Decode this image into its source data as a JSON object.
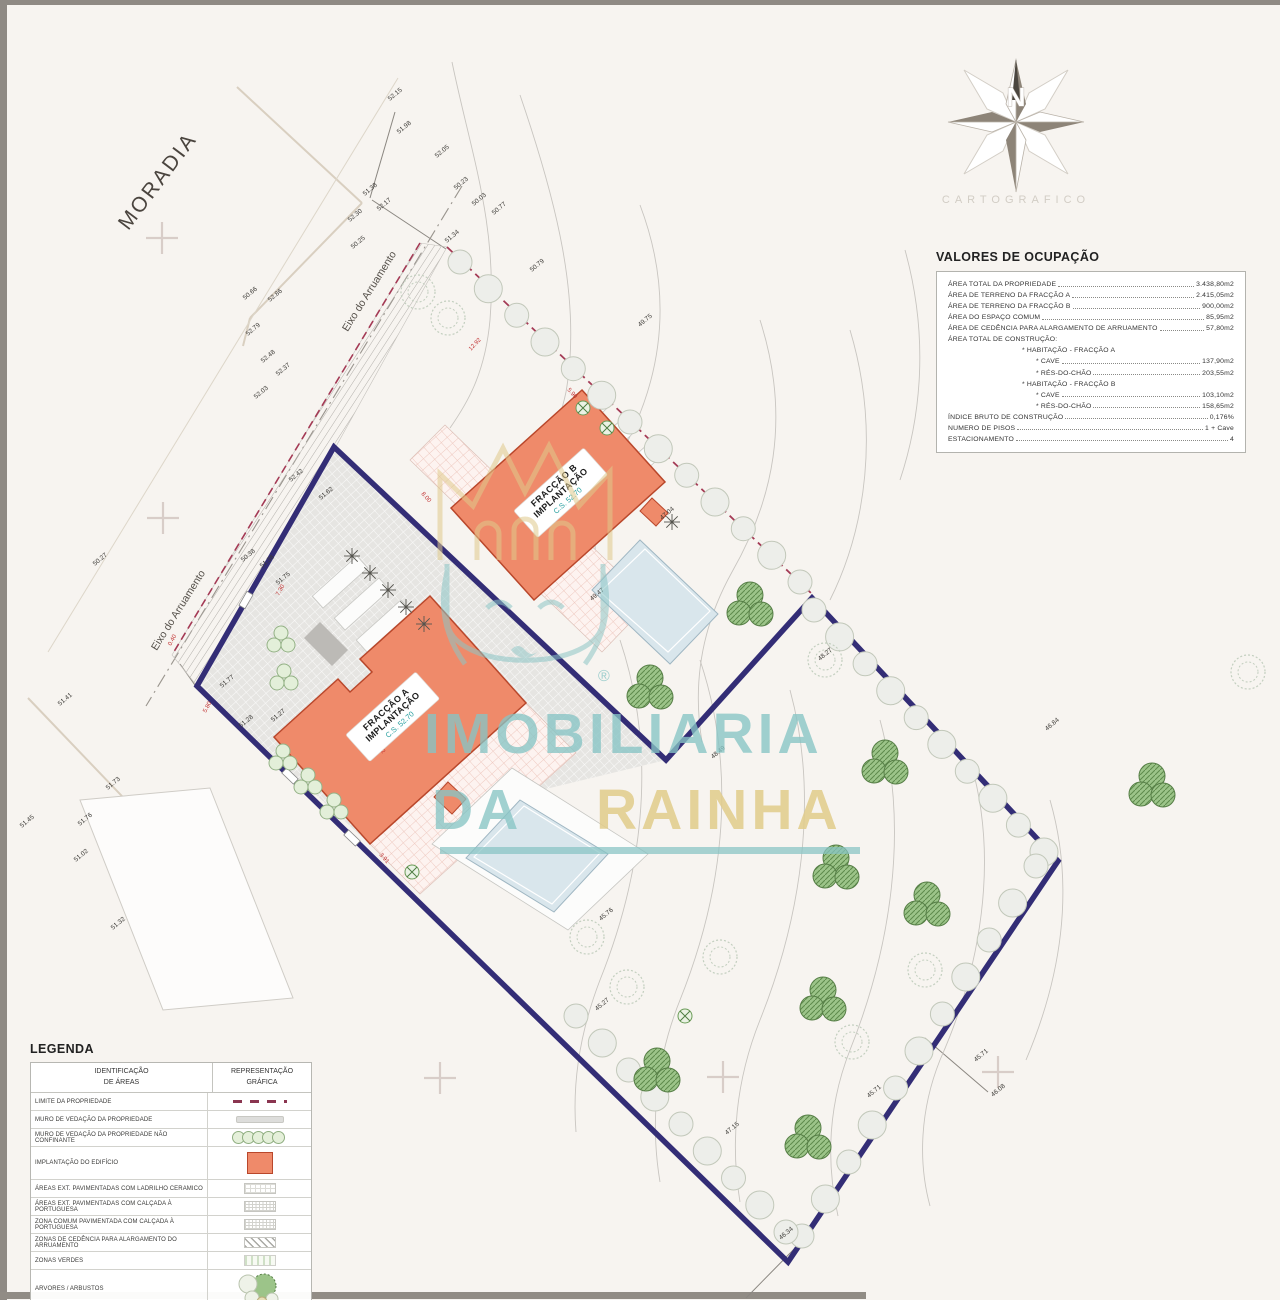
{
  "colors": {
    "salmon": "#ef8a6a",
    "salmon_border": "#b9472b",
    "navy": "#332d76",
    "limit_red": "#a43a55",
    "teal": "#86c4c4",
    "gold": "#e0cb8c",
    "pool": "#d9e6ec",
    "paving": "#e6e5e2"
  },
  "compass": {
    "north": "N",
    "caption": "CARTOGRAFICO"
  },
  "watermark": {
    "word1": "IMOBILIARIA",
    "word2": "DA",
    "word3": "RAINHA",
    "reg": "®"
  },
  "plan": {
    "moradia": "MORADIA",
    "eixo_label": "Eixo do Arruamento",
    "building_a": {
      "name": "FRACÇÃO A",
      "sub": "IMPLANTAÇÃO",
      "cs": "C.S. 52.70"
    },
    "building_b": {
      "name": "FRACÇÃO B",
      "sub": "IMPLANTAÇÃO",
      "cs": "C.S. 52.70"
    },
    "elevations": [
      {
        "v": "52.15",
        "x": 390,
        "y": 101
      },
      {
        "v": "51.98",
        "x": 399,
        "y": 134
      },
      {
        "v": "52.05",
        "x": 437,
        "y": 158
      },
      {
        "v": "51.38",
        "x": 365,
        "y": 196
      },
      {
        "v": "52.30",
        "x": 350,
        "y": 222
      },
      {
        "v": "52.17",
        "x": 379,
        "y": 211
      },
      {
        "v": "50.25",
        "x": 353,
        "y": 249
      },
      {
        "v": "50.66",
        "x": 245,
        "y": 300
      },
      {
        "v": "52.86",
        "x": 270,
        "y": 302
      },
      {
        "v": "52.79",
        "x": 248,
        "y": 336
      },
      {
        "v": "52.48",
        "x": 263,
        "y": 363
      },
      {
        "v": "52.37",
        "x": 278,
        "y": 376
      },
      {
        "v": "52.03",
        "x": 256,
        "y": 399
      },
      {
        "v": "50.23",
        "x": 456,
        "y": 190
      },
      {
        "v": "50.03",
        "x": 474,
        "y": 206
      },
      {
        "v": "50.77",
        "x": 494,
        "y": 215
      },
      {
        "v": "51.34",
        "x": 447,
        "y": 243
      },
      {
        "v": "50.79",
        "x": 532,
        "y": 272
      },
      {
        "v": "49.75",
        "x": 640,
        "y": 327
      },
      {
        "v": "52.42",
        "x": 291,
        "y": 482
      },
      {
        "v": "51.62",
        "x": 321,
        "y": 500
      },
      {
        "v": "50.38",
        "x": 243,
        "y": 562
      },
      {
        "v": "51.36",
        "x": 262,
        "y": 568
      },
      {
        "v": "51.75",
        "x": 278,
        "y": 585
      },
      {
        "v": "50.27",
        "x": 95,
        "y": 566
      },
      {
        "v": "51.41",
        "x": 60,
        "y": 706
      },
      {
        "v": "51.77",
        "x": 222,
        "y": 688
      },
      {
        "v": "51.28",
        "x": 241,
        "y": 728
      },
      {
        "v": "51.27",
        "x": 273,
        "y": 722
      },
      {
        "v": "51.73",
        "x": 108,
        "y": 790
      },
      {
        "v": "51.76",
        "x": 80,
        "y": 826
      },
      {
        "v": "51.45",
        "x": 22,
        "y": 828
      },
      {
        "v": "51.02",
        "x": 76,
        "y": 862
      },
      {
        "v": "51.32",
        "x": 113,
        "y": 930
      },
      {
        "v": "49.47",
        "x": 592,
        "y": 601
      },
      {
        "v": "47.04",
        "x": 662,
        "y": 520
      },
      {
        "v": "48.27",
        "x": 820,
        "y": 661
      },
      {
        "v": "46.84",
        "x": 1047,
        "y": 731
      },
      {
        "v": "48.49",
        "x": 713,
        "y": 759
      },
      {
        "v": "45.76",
        "x": 601,
        "y": 921
      },
      {
        "v": "45.27",
        "x": 597,
        "y": 1011
      },
      {
        "v": "47.15",
        "x": 727,
        "y": 1135
      },
      {
        "v": "45.71",
        "x": 976,
        "y": 1062
      },
      {
        "v": "46.08",
        "x": 993,
        "y": 1097
      },
      {
        "v": "45.71",
        "x": 869,
        "y": 1098
      },
      {
        "v": "46.34",
        "x": 781,
        "y": 1240
      }
    ],
    "dimensions": [
      {
        "v": "12.92",
        "x": 471,
        "y": 351,
        "r": -47
      },
      {
        "v": "5.90",
        "x": 567,
        "y": 390,
        "r": 48
      },
      {
        "v": "8.00",
        "x": 421,
        "y": 494,
        "r": 48
      },
      {
        "v": "7.30",
        "x": 279,
        "y": 596,
        "r": -62
      },
      {
        "v": "3.92",
        "x": 375,
        "y": 745,
        "r": 48
      },
      {
        "v": "3.91",
        "x": 379,
        "y": 855,
        "r": 48
      },
      {
        "v": "0.40",
        "x": 171,
        "y": 646,
        "r": -62
      },
      {
        "v": "5.80",
        "x": 206,
        "y": 713,
        "r": -62
      }
    ],
    "crosses": [
      [
        162,
        238
      ],
      [
        163,
        518
      ],
      [
        440,
        1078
      ],
      [
        723,
        1077
      ],
      [
        998,
        1072
      ]
    ],
    "shrub_rows": [
      {
        "from": [
          460,
          262
        ],
        "to": [
          800,
          582
        ],
        "n": 13
      },
      {
        "from": [
          814,
          610
        ],
        "to": [
          1044,
          852
        ],
        "n": 10
      },
      {
        "from": [
          1036,
          866
        ],
        "to": [
          802,
          1236
        ],
        "n": 11
      },
      {
        "from": [
          576,
          1016
        ],
        "to": [
          786,
          1232
        ],
        "n": 9
      }
    ],
    "tree_clusters": [
      [
        750,
        607
      ],
      [
        650,
        690
      ],
      [
        885,
        765
      ],
      [
        1152,
        788
      ],
      [
        836,
        870
      ],
      [
        927,
        907
      ],
      [
        823,
        1002
      ],
      [
        657,
        1073
      ],
      [
        808,
        1140
      ]
    ],
    "outline_trees": [
      [
        587,
        937
      ],
      [
        627,
        987
      ],
      [
        720,
        957
      ],
      [
        852,
        1042
      ],
      [
        925,
        970
      ],
      [
        825,
        660
      ],
      [
        418,
        292
      ],
      [
        448,
        318
      ],
      [
        1248,
        672
      ]
    ],
    "x_trees": [
      [
        583,
        408
      ],
      [
        607,
        428
      ],
      [
        412,
        872
      ],
      [
        685,
        1016
      ]
    ],
    "spiky_trees": [
      [
        352,
        556
      ],
      [
        370,
        573
      ],
      [
        388,
        590
      ],
      [
        406,
        607
      ],
      [
        424,
        624
      ],
      [
        672,
        522
      ]
    ],
    "green_dots": [
      [
        281,
        640
      ],
      [
        284,
        678
      ],
      [
        283,
        758
      ],
      [
        308,
        782
      ],
      [
        334,
        807
      ]
    ]
  },
  "valores": {
    "title": "VALORES DE OCUPAÇÃO",
    "rows": [
      {
        "label": "ÁREA TOTAL DA PROPRIEDADE",
        "value": "3.438,80m2",
        "indent": 0
      },
      {
        "label": "ÁREA DE TERRENO DA FRACÇÃO A",
        "value": "2.415,05m2",
        "indent": 0
      },
      {
        "label": "ÁREA DE TERRENO DA FRACÇÃO B",
        "value": "900,00m2",
        "indent": 0
      },
      {
        "label": "ÁREA DO ESPAÇO COMUM",
        "value": "85,95m2",
        "indent": 0
      },
      {
        "label": "ÁREA DE CEDÊNCIA PARA ALARGAMENTO DE ARRUAMENTO",
        "value": "57,80m2",
        "indent": 0
      },
      {
        "label": "ÁREA TOTAL DE CONSTRUÇÃO:",
        "value": "",
        "indent": 0
      },
      {
        "label": "* HABITAÇÃO - FRACÇÃO A",
        "value": "",
        "indent": 1
      },
      {
        "label": "* CAVE",
        "value": "137,90m2",
        "indent": 2
      },
      {
        "label": "* RÉS-DO-CHÃO",
        "value": "203,55m2",
        "indent": 2
      },
      {
        "label": "* HABITAÇÃO - FRACÇÃO B",
        "value": "",
        "indent": 1
      },
      {
        "label": "* CAVE",
        "value": "103,10m2",
        "indent": 2
      },
      {
        "label": "* RÉS-DO-CHÃO",
        "value": "158,65m2",
        "indent": 2
      },
      {
        "label": "ÍNDICE BRUTO DE CONSTRUÇÃO",
        "value": "0,176%",
        "indent": 0
      },
      {
        "label": "NUMERO DE PISOS",
        "value": "1 + Cave",
        "indent": 0
      },
      {
        "label": "ESTACIONAMENTO",
        "value": "4",
        "indent": 0
      }
    ]
  },
  "legend": {
    "title": "LEGENDA",
    "header": {
      "c1a": "IDENTIFICAÇÃO",
      "c1b": "DE ÁREAS",
      "c2a": "REPRESENTAÇÃO",
      "c2b": "GRÁFICA"
    },
    "rows": [
      {
        "label": "LIMITE DA PROPRIEDADE",
        "symbol": "limit"
      },
      {
        "label": "MURO DE VEDAÇÃO DA PROPRIEDADE",
        "symbol": "wall"
      },
      {
        "label": "MURO DE VEDAÇÃO DA PROPRIEDADE NÃO CONFINANTE",
        "symbol": "hedge"
      },
      {
        "label": "IMPLANTAÇÃO DO EDIFÍCIO",
        "symbol": "building"
      },
      {
        "label": "ÁREAS EXT. PAVIMENTADAS COM LADRILHO CERAMICO",
        "symbol": "tile"
      },
      {
        "label": "ÁREAS EXT. PAVIMENTADAS COM CALÇADA À PORTUGUESA",
        "symbol": "calcada"
      },
      {
        "label": "ZONA COMUM PAVIMENTADA COM CALÇADA À PORTUGUESA",
        "symbol": "calcada2"
      },
      {
        "label": "ZONAS DE CEDÊNCIA PARA ALARGAMENTO DO ARRUAMENTO",
        "symbol": "cedencia"
      },
      {
        "label": "ZONAS VERDES",
        "symbol": "verde"
      },
      {
        "label": "ARVORES / ARBUSTOS",
        "symbol": "arvores"
      }
    ]
  }
}
